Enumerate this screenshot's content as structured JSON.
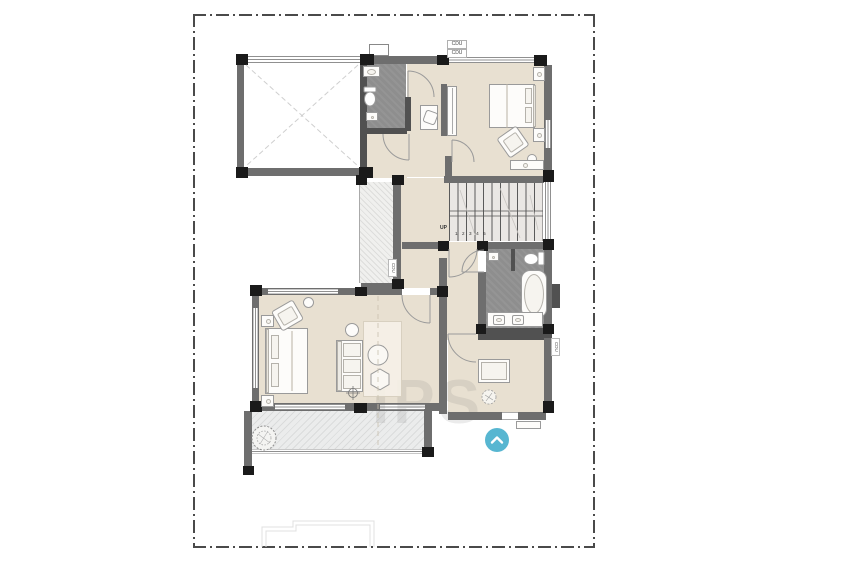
{
  "canvas": {
    "width": 850,
    "height": 567,
    "background": "#ffffff"
  },
  "plan": {
    "type": "architectural-floor-plan",
    "boundary": {
      "style": "dash-dot",
      "color": "#4a4a4a"
    },
    "labels": {
      "cdu_top_1": "CDU",
      "cdu_top_2": "CDU",
      "cdu_shaft_left": "CDU",
      "cdu_right": "CDU"
    },
    "stairs": {
      "direction_label": "UP",
      "step_numbers": "1 2 3 4 5"
    },
    "watermark_text": "IPS",
    "logo": {
      "shape": "circle",
      "color": "#57b6d1",
      "icon": "chevron-up"
    },
    "colors": {
      "wall": "#6e6e6e",
      "wall_dark": "#515151",
      "column": "#1a1a1a",
      "floor_main": "#e8e0d1",
      "floor_bathroom": "#8e8e8e",
      "floor_stairs": "#eae7e4",
      "balcony_hatch": "#ebecec",
      "logo_blue": "#57b6d1"
    }
  }
}
